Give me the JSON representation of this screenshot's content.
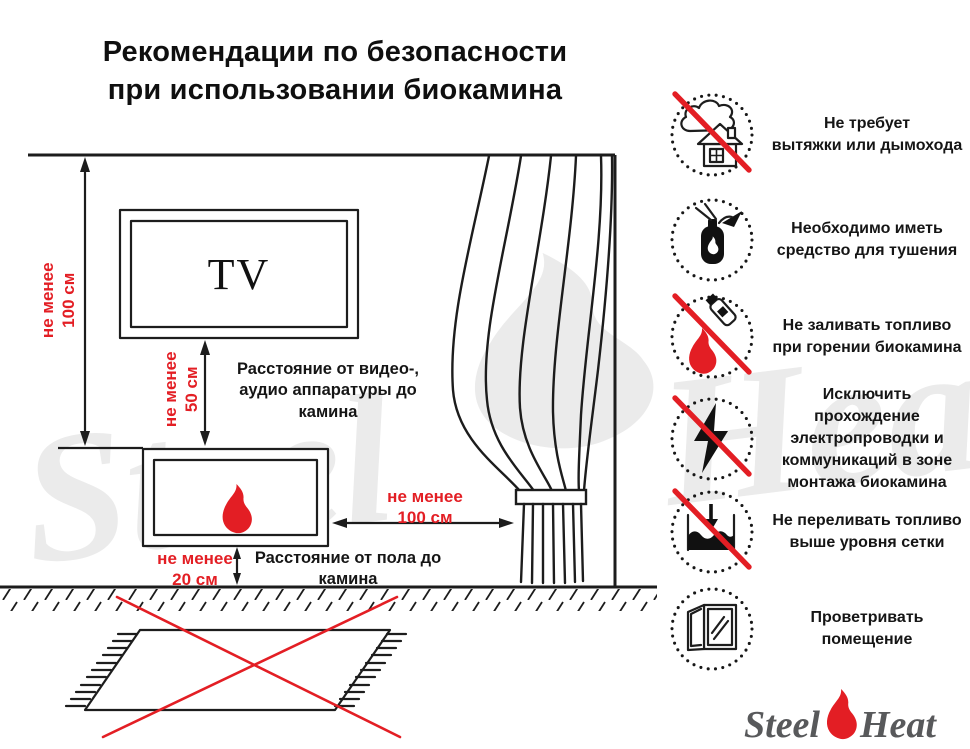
{
  "title": "Рекомендации по безопасности\nпри использовании биокамина",
  "colors": {
    "red": "#e31e24",
    "ink": "#1c1c1c",
    "logo": "#58595b",
    "wm": "#ebebeb"
  },
  "diagram": {
    "tv_label": "TV",
    "wall_dim": "не менее\n100 см",
    "tv_dim": "не менее\n50 см",
    "tv_note": "Расстояние от видео-,\nаудио аппаратуры до\nкамина",
    "side_dim": "не менее\n100 см",
    "floor_dim": "не менее\n20 см",
    "floor_note": "Расстояние от пола до\nкамина"
  },
  "recommendations": [
    {
      "icon": "no-chimney-icon",
      "text": "Не требует\nвытяжки или дымохода"
    },
    {
      "icon": "extinguisher-icon",
      "text": "Необходимо иметь\nсредство для тушения"
    },
    {
      "icon": "no-refill-burning-icon",
      "text": "Не заливать топливо\nпри горении биокамина"
    },
    {
      "icon": "no-wiring-icon",
      "text": "Исключить прохождение\nэлектропроводки и\nкоммуникаций в зоне\nмонтажа биокамина"
    },
    {
      "icon": "no-overfill-icon",
      "text": "Не переливать топливо\nвыше уровня сетки"
    },
    {
      "icon": "ventilate-icon",
      "text": "Проветривать\nпомещение"
    }
  ],
  "logo": {
    "part1": "Steel",
    "part2": "Heat"
  },
  "watermark": {
    "part1": "Steel",
    "part2": "Heat"
  }
}
